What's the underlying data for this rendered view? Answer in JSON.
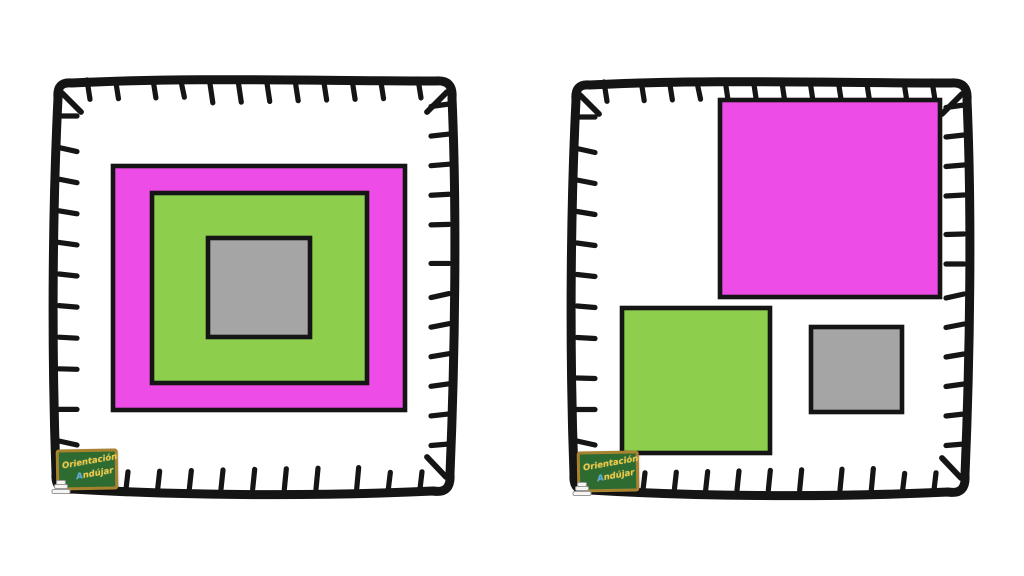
{
  "background": "#ffffff",
  "colors": {
    "outline": "#151515",
    "magenta": "#ee4ce6",
    "green": "#8dce4d",
    "gray": "#a5a5a5"
  },
  "logo": {
    "line1": "Orientación",
    "line2": "Andújar",
    "board_color": "#2e6b31",
    "frame_color": "#a8832f",
    "text_color": "#f2c83e",
    "accent_color": "#58ace0"
  },
  "panels": [
    {
      "name": "nested-squares-panel",
      "frame": {
        "x": 48,
        "y": 70,
        "width": 412,
        "height": 430
      },
      "shapes": [
        {
          "name": "magenta-square",
          "color_key": "magenta",
          "x": 65,
          "y": 96,
          "width": 292,
          "height": 244
        },
        {
          "name": "green-square",
          "color_key": "green",
          "x": 104,
          "y": 123,
          "width": 215,
          "height": 190
        },
        {
          "name": "gray-square",
          "color_key": "gray",
          "x": 160,
          "y": 168,
          "width": 102,
          "height": 99
        }
      ]
    },
    {
      "name": "scattered-squares-panel",
      "frame": {
        "x": 566,
        "y": 72,
        "width": 409,
        "height": 429
      },
      "shapes": [
        {
          "name": "magenta-square",
          "color_key": "magenta",
          "x": 154,
          "y": 28,
          "width": 220,
          "height": 197
        },
        {
          "name": "green-square",
          "color_key": "green",
          "x": 56,
          "y": 236,
          "width": 148,
          "height": 145
        },
        {
          "name": "gray-square",
          "color_key": "gray",
          "x": 245,
          "y": 255,
          "width": 91,
          "height": 85
        }
      ]
    }
  ]
}
